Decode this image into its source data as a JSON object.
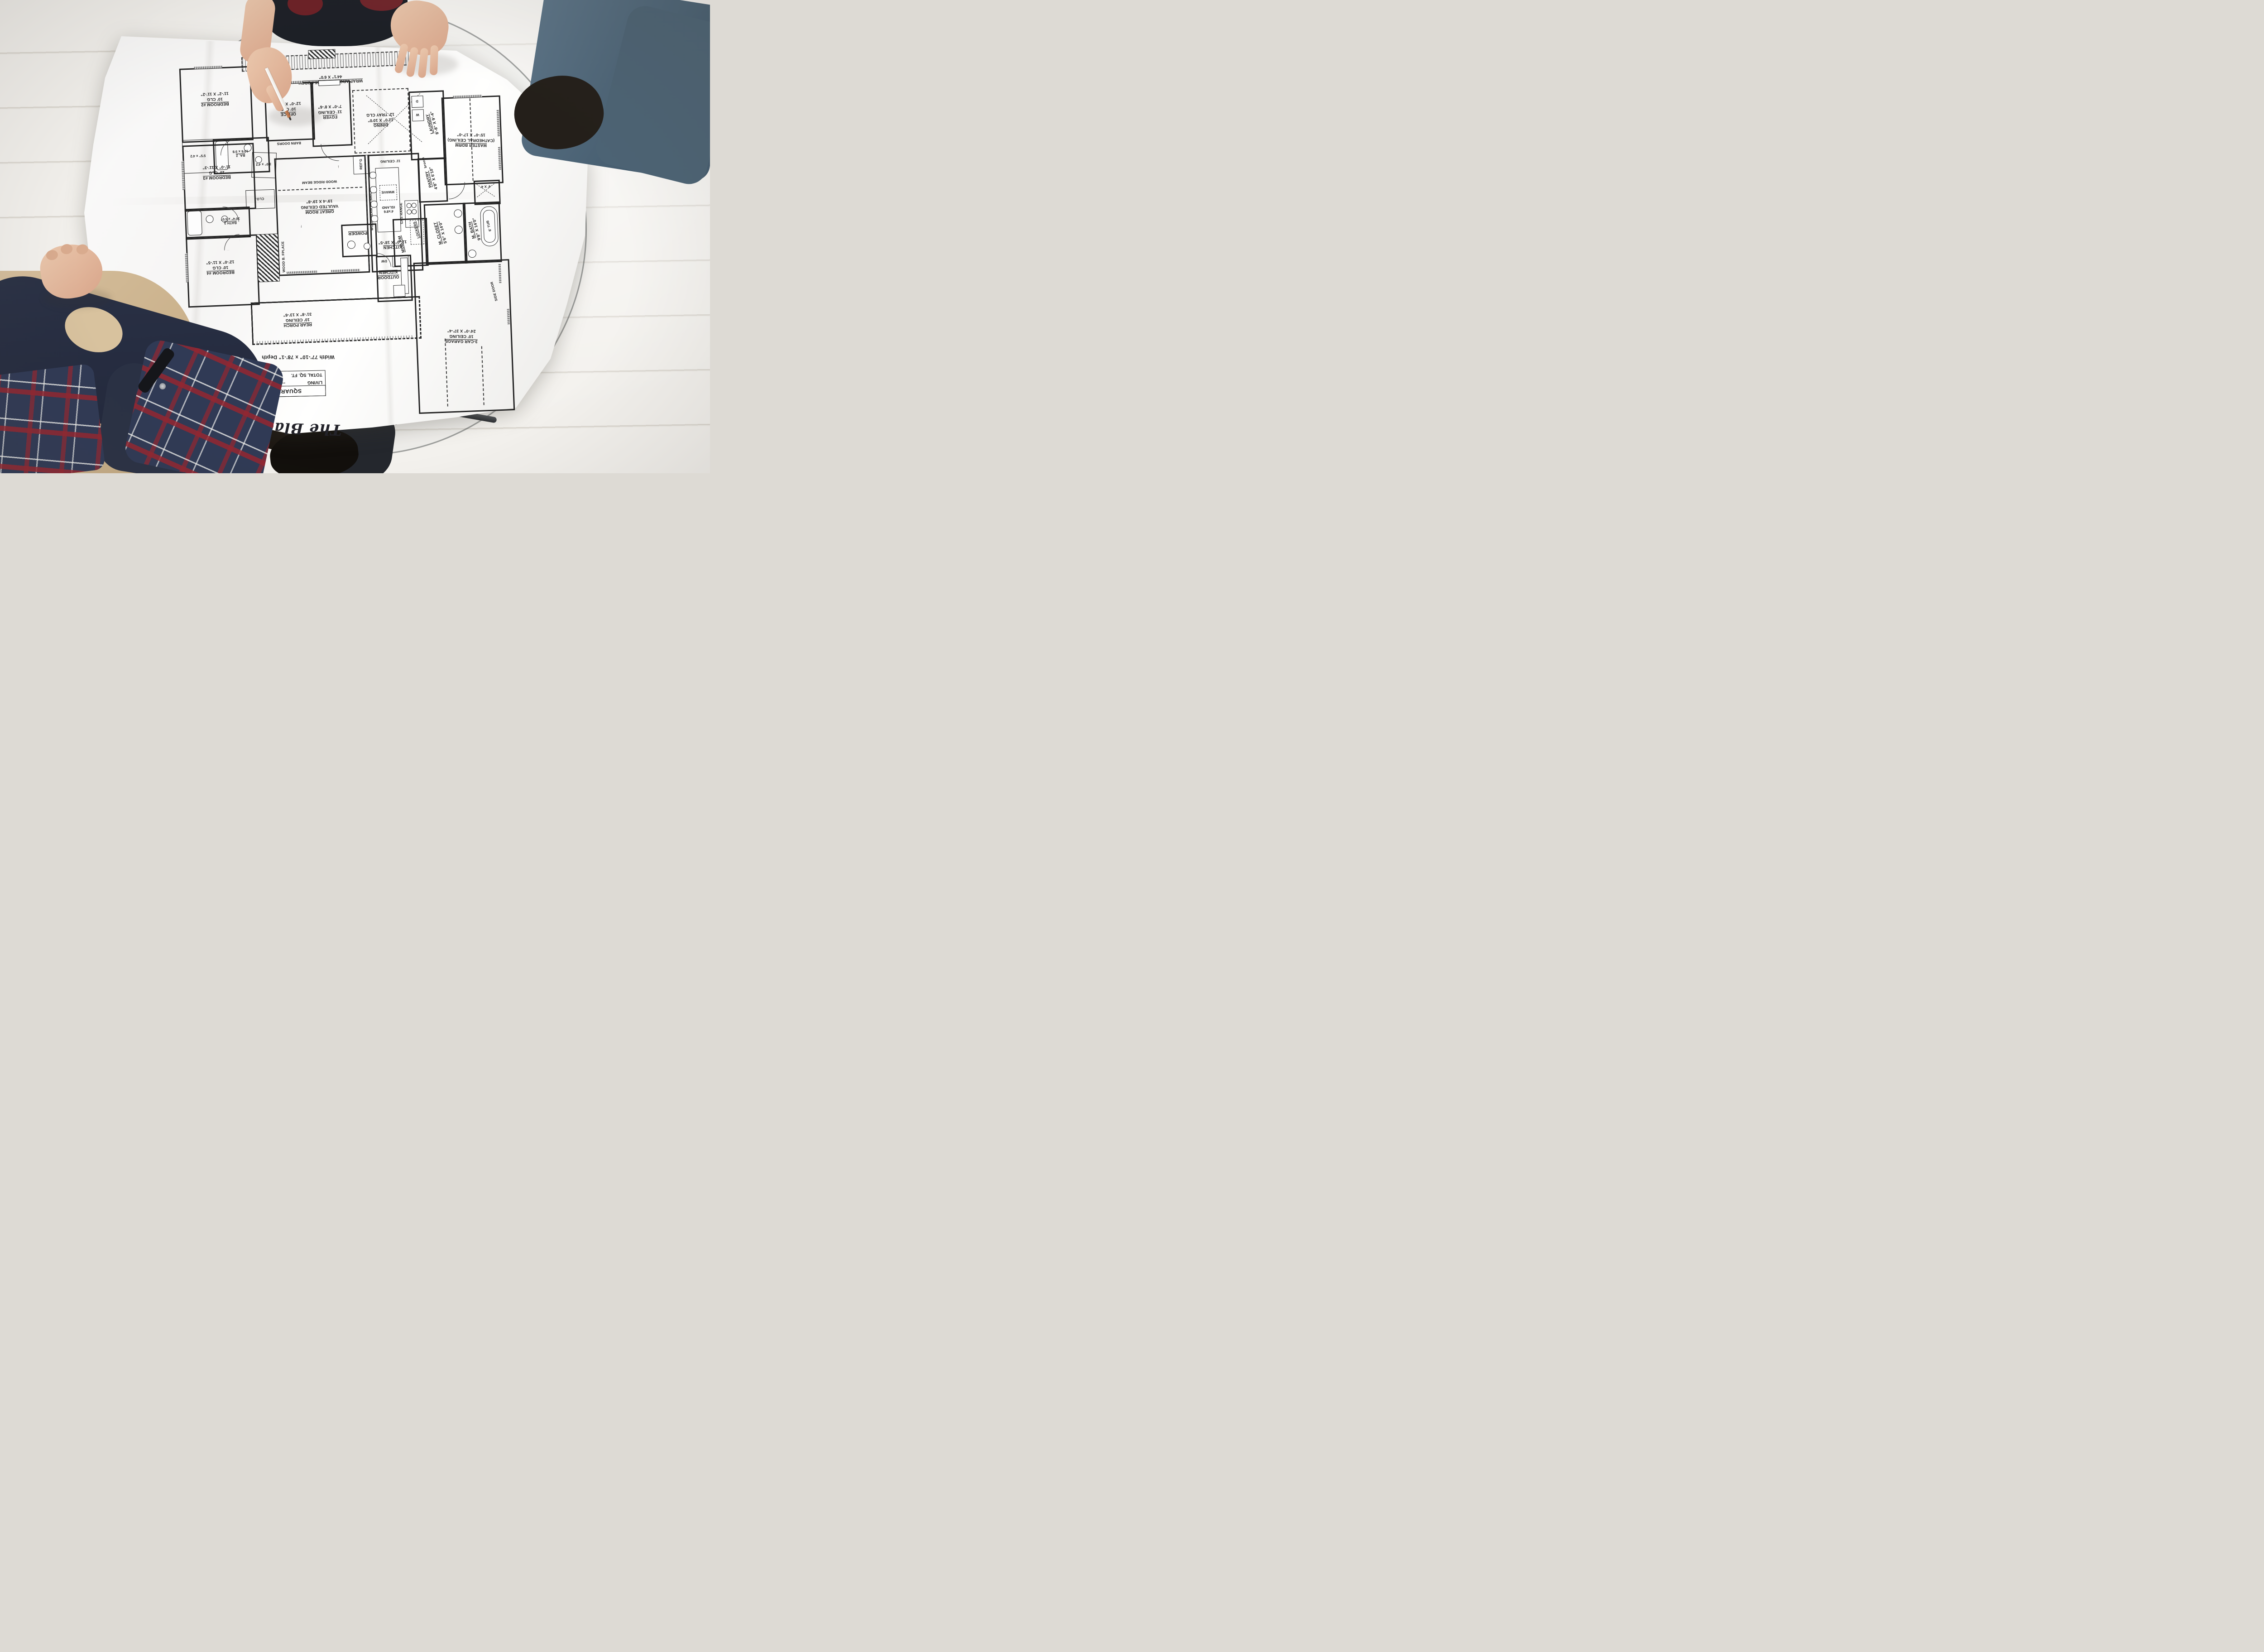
{
  "plan": {
    "title": "The Black Creek",
    "size_note": "Width 77'-10\" x 78'-1\" Depth",
    "square_footage": {
      "heading": "SQUARE FOOTAGE",
      "living_label": "LIVING",
      "living_dots": "------------------",
      "living_value": "2400",
      "total_label": "TOTAL SQ. FT.",
      "total_dots": "-------------",
      "total_value": "4064"
    },
    "rooms": {
      "front_porch": {
        "name": "WRAP AROUND FRONT PORCH",
        "dims": "44'1\" X 6'0\""
      },
      "bedroom2": {
        "name": "BEDROOM #2",
        "ceiling": "10' CLG",
        "dims": "11'-2\" X 11'-2\""
      },
      "bedroom2_closet": {
        "dims": "5'5\" x 4'2"
      },
      "bath2": {
        "name": "BA. 2",
        "dims": "10'6 x 5'8"
      },
      "office": {
        "name": "OFFICE",
        "ceiling": "10' CLG",
        "dims": "12'-0\" X 8'-6\""
      },
      "foyer": {
        "name": "FOYER",
        "ceiling": "11' CEILING",
        "dims": "7'-0\" X 8'-6\""
      },
      "dining": {
        "name": "DINING",
        "dims": "12'0\" X 10'0\"",
        "ceiling": "12' TRAY CLG"
      },
      "laundry": {
        "name": "LAUNDRY",
        "dims": "8'-8\" X 9'-4\""
      },
      "master_bedroom": {
        "name": "MASTER BDRM",
        "ceiling": "(CATHEDRAL CEILING)",
        "dims": "15'-0\" X 17'-0\""
      },
      "bedroom3": {
        "name": "BEDROOM #3",
        "ceiling": "10' CLG",
        "dims": "11'-0\" X 11'-3\""
      },
      "bedroom3_closet": {
        "dims": "3'0\" x 4'2"
      },
      "closet_abbr": "CLO.",
      "great_room": {
        "name": "GREAT ROOM",
        "ceiling": "VAULTED CEILING",
        "dims": "19'-4 X 19'-8\""
      },
      "kitchen": {
        "name": "KITCHEN",
        "dims": "12'-0\" X 18'-5\"",
        "ceiling": "11' CEILING"
      },
      "island": {
        "dims": "4'x8'6",
        "name": "ISLAND"
      },
      "pantry": {
        "name": "PANTRY",
        "dims": "4'8\" X 6'10\""
      },
      "master_closet": {
        "name": "M. CLOSET",
        "dims": "5'6\" X 14'0\""
      },
      "master_bath": {
        "name": "M. BATH",
        "dims": "9'8\" X 14'0\""
      },
      "shower": {
        "dims": "4' X 4'"
      },
      "tub": {
        "name": "6' TUB"
      },
      "bath3": {
        "name": "BATH 3",
        "dims": "10'4\" x 5'0\""
      },
      "bedroom4": {
        "name": "BEDROOM #4",
        "ceiling": "10' CLG",
        "dims": "12'-0\" X 11'-5\""
      },
      "fireplace": {
        "name": "WOOD B. FPLACE"
      },
      "rear_porch": {
        "name": "REAR PORCH",
        "ceiling": "10' CEILING",
        "dims": "31'-8\" X 13'-6\""
      },
      "powder": {
        "name": "POWDER"
      },
      "outdoor_kitchen": {
        "name": "OUTDOOR KITCHEN"
      },
      "mud_room": {
        "name": "MUD RM"
      },
      "lockers": {
        "name": "LOCKERS"
      },
      "garage": {
        "name": "3-CAR GARAGE",
        "ceiling": "10' CEILING",
        "dims": "24'-0\" X 37'-4\""
      },
      "side_door": {
        "name": "SIDE DOOR"
      }
    },
    "annotations": {
      "barn_doors": "BARN DOORS",
      "wood_ridge_beam": "WOOD RIDGE BEAM",
      "wood_beam_on_brick": "WOOD BEAM ON BRICK",
      "gas_range": "GAS RANGE",
      "mwave": "MWAVE",
      "refg": "REF'G",
      "dw": "DW",
      "washer": "W",
      "dryer": "D",
      "broom": "broom",
      "arrow_up": "↑",
      "arrow_down": "↓"
    },
    "palette": {
      "paper": "#f8f7f5",
      "ink": "#242424",
      "floor": "#eceae5",
      "denim": "#5d7588",
      "jacket_tan": "#d6bf9d",
      "sleeve_navy": "#2b3246",
      "plaid_navy": "#303a55",
      "plaid_red": "#942630",
      "pencil_tip_copper": "#a9613c"
    }
  }
}
